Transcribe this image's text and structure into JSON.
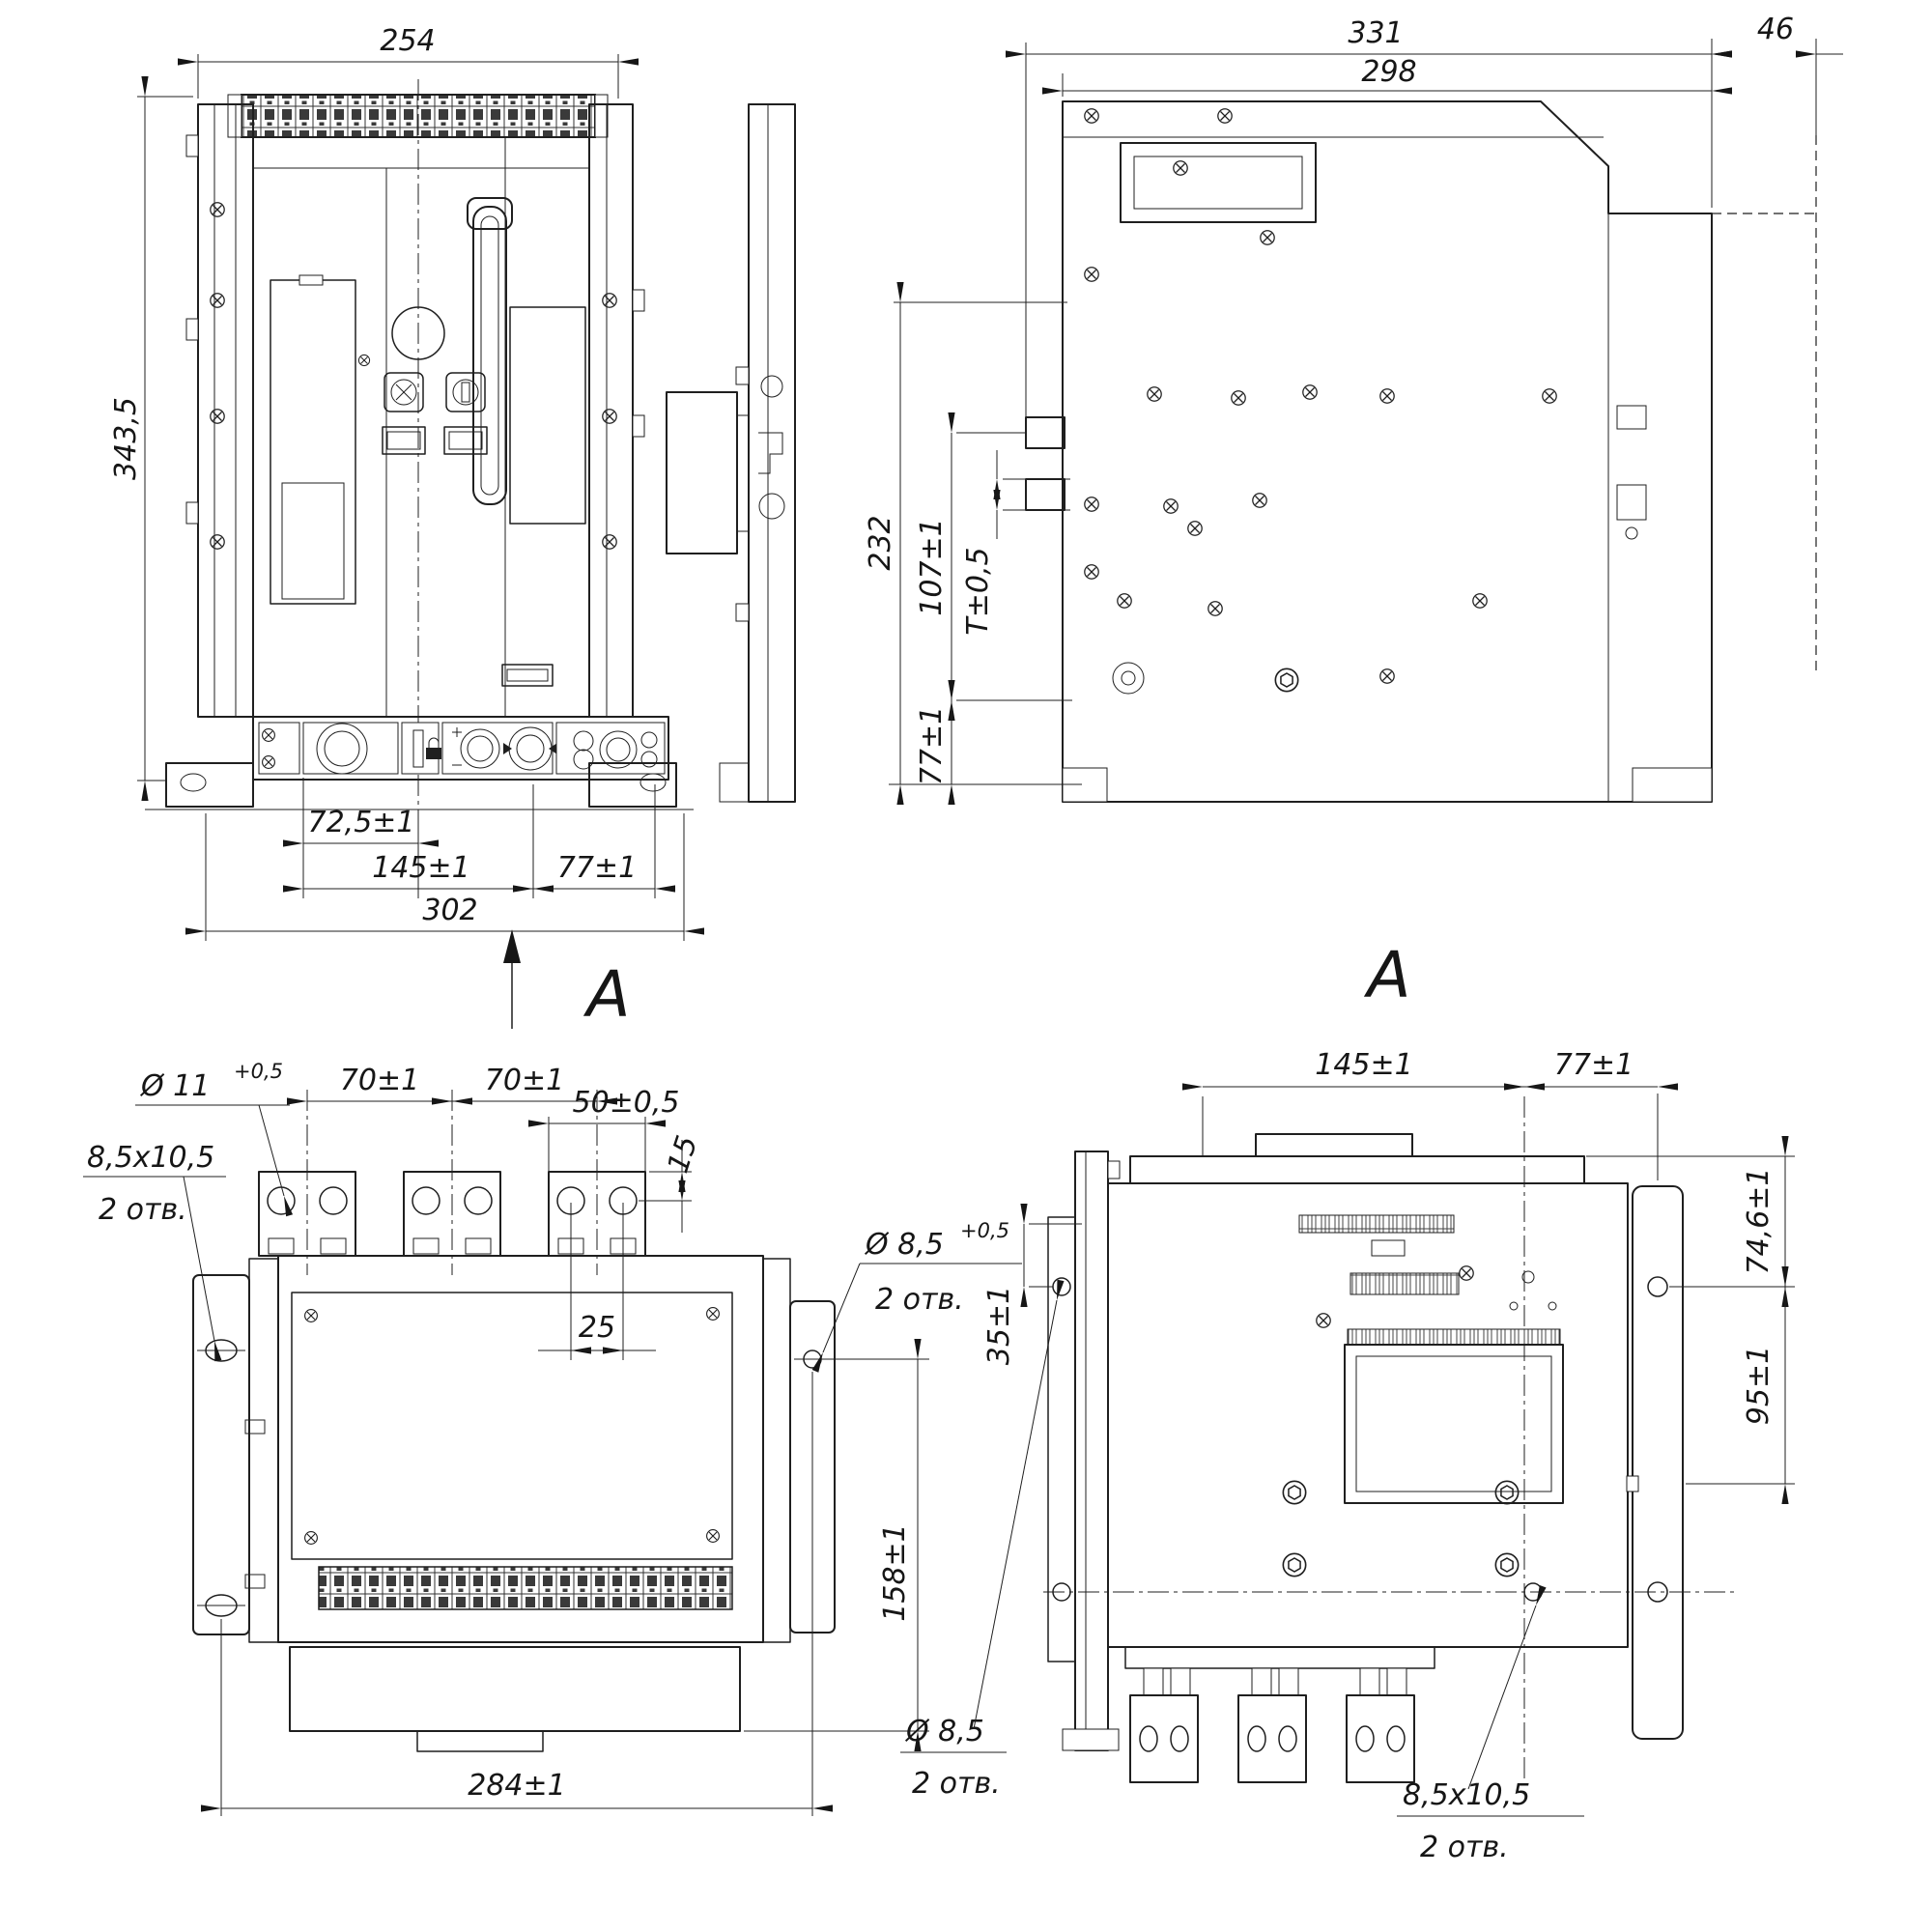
{
  "front": {
    "section_letter": "A",
    "dim_width_top": "254",
    "dim_height": "343,5",
    "dim_knob": "72,5±1",
    "dim_center": "145±1",
    "dim_right": "77±1",
    "dim_overall": "302"
  },
  "side": {
    "dim_depth": "331",
    "dim_depth_inner": "298",
    "dim_front": "46",
    "dim_height": "232",
    "dim_shafts": "107±1",
    "dim_panel": "T±0,5",
    "dim_base": "77±1"
  },
  "top": {
    "label_hole_dia": "Ø 11",
    "label_hole_tol": "+0,5",
    "dim_pitch1": "70±1",
    "dim_pitch2": "70±1",
    "dim_bar": "50±0,5",
    "dim_edge": "15",
    "dim_holes": "25",
    "label_slot": "8,5x10,5",
    "label_slot_qty": "2 отв.",
    "label_flange": "Ø 8,5",
    "label_flange_tol": "+0,5",
    "label_flange_qty": "2 отв.",
    "dim_flange_v": "158±1",
    "dim_mount": "284±1"
  },
  "rear": {
    "view_letter": "A",
    "dim_left": "145±1",
    "dim_right": "77±1",
    "dim_top": "74,6±1",
    "dim_side": "95±1",
    "dim_offset": "35±1",
    "label_hole": "Ø 8,5",
    "label_hole_qty": "2 отв.",
    "label_slot": "8,5x10,5",
    "label_slot_qty": "2 отв."
  }
}
